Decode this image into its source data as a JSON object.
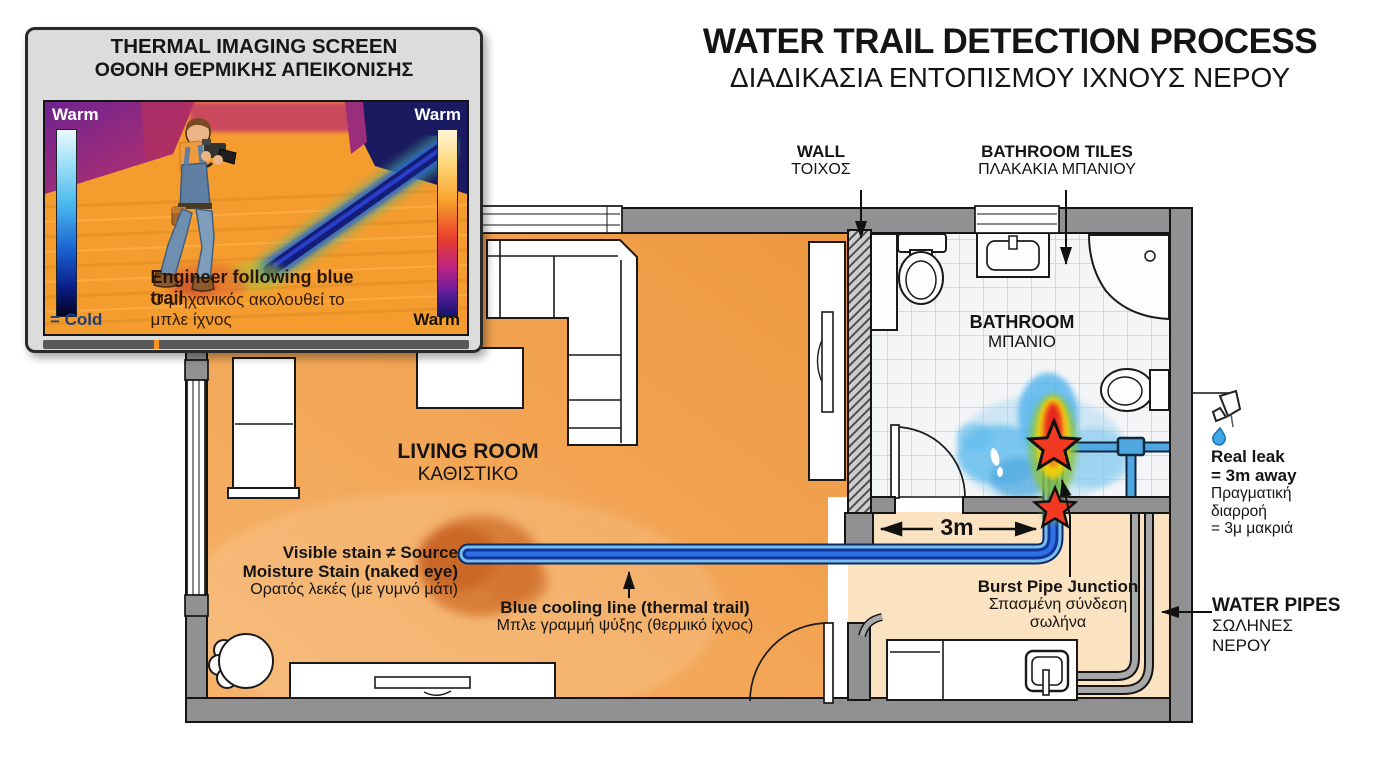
{
  "title": {
    "en": "WATER TRAIL DETECTION PROCESS",
    "el": "ΔΙΑΔΙΚΑΣΙΑ ΕΝΤΟΠΙΣΜΟΥ ΙΧΝΟΥΣ ΝΕΡΟΥ"
  },
  "screen": {
    "title_en": "THERMAL IMAGING SCREEN",
    "title_el": "ΟΘΟΝΗ ΘΕΡΜΙΚΗΣ ΑΠΕΙΚΟΝΙΣΗΣ",
    "warm_tl": "Warm",
    "warm_tr": "Warm",
    "cold_bl": "= Cold",
    "warm_br": "Warm",
    "caption_en": "Engineer following blue trail",
    "caption_el": "Ο μηχανικός ακολουθεί το μπλε ίχνος"
  },
  "rooms": {
    "living_en": "LIVING ROOM",
    "living_el": "ΚΑΘΙΣΤΙΚΟ",
    "bath_en": "BATHROOM",
    "bath_el": "ΜΠΑΝΙΟ"
  },
  "callouts": {
    "wall_en": "WALL",
    "wall_el": "ΤΟΙΧΟΣ",
    "tiles_en": "BATHROOM TILES",
    "tiles_el": "ΠΛΑΚΑΚΙΑ ΜΠΑΝΙΟΥ",
    "stain_l1": "Visible stain ≠ Source",
    "stain_l2": "Moisture Stain (naked eye)",
    "stain_el": "Ορατός λεκές (με γυμνό μάτι)",
    "cooling_en": "Blue cooling line (thermal trail)",
    "cooling_el": "Μπλε γραμμή ψύξης (θερμικό ίχνος)",
    "burst_en": "Burst Pipe Junction",
    "burst_el1": "Σπασμένη σύνδεση",
    "burst_el2": "σωλήνα",
    "leak_en1": "Real leak",
    "leak_en2": "= 3m away",
    "leak_el1": "Πραγματική",
    "leak_el2": "διαρροή",
    "leak_el3": "= 3μ μακριά",
    "pipes_en": "WATER PIPES",
    "pipes_el1": "ΣΩΛΗΝΕΣ",
    "pipes_el2": "ΝΕΡΟΥ"
  },
  "dimension": {
    "value": "3m"
  },
  "colors": {
    "living_floor": "#f2a14f",
    "hall_floor": "#fbe3c2",
    "wall_gray": "#919193",
    "cooling_line_blue": "#10379e",
    "hot_spot_red": "#e8281e",
    "star_red": "#f23a22",
    "water_spread_blue": "#5fbcee"
  }
}
